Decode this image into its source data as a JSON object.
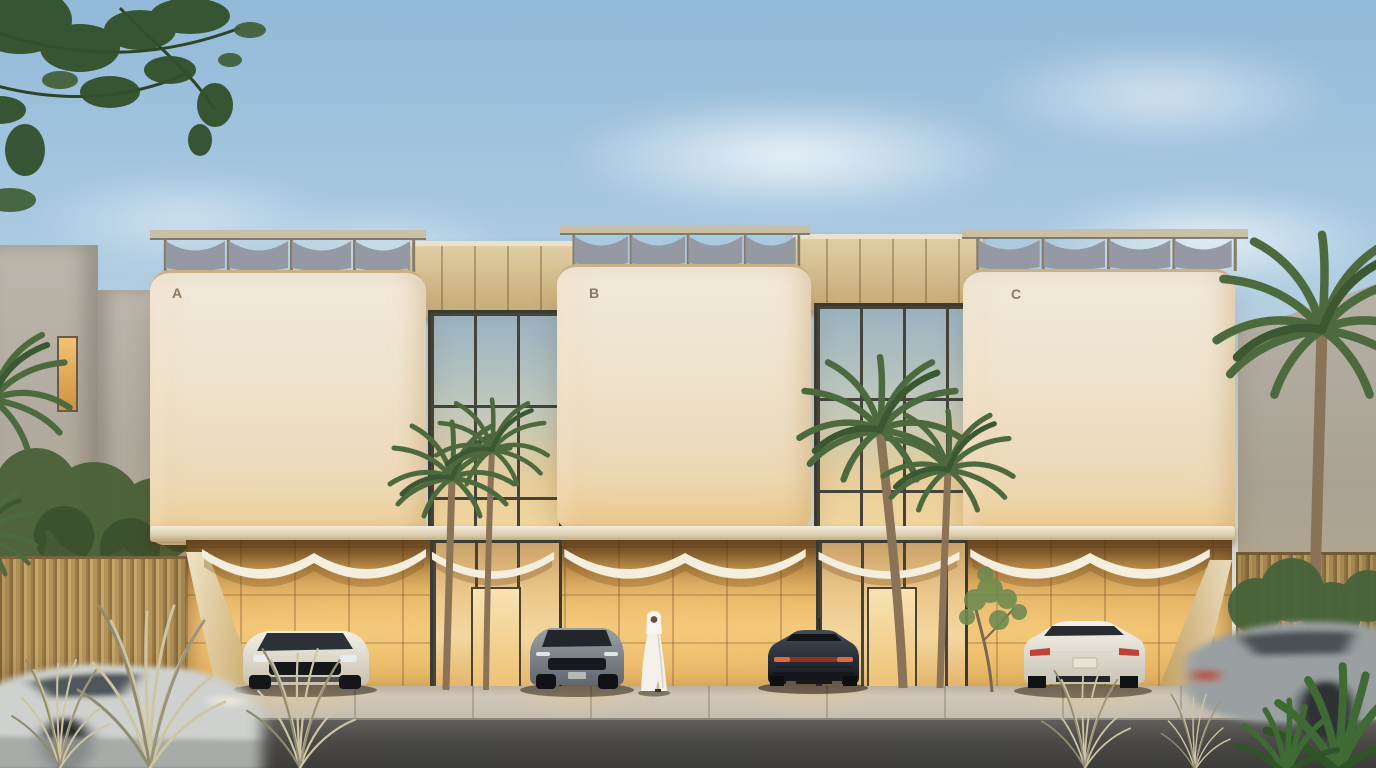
{
  "scene": {
    "description": "Dusk architectural rendering of a three-unit modern villa complex with rooftop pergolas, glowing golden stone ground floor, glass links, palm trees, parked luxury cars and a man in a white kandura",
    "units": [
      {
        "label": "A"
      },
      {
        "label": "B"
      },
      {
        "label": "C"
      }
    ],
    "objects": {
      "vehicles": [
        "white-suv-parked",
        "grey-suv-parked",
        "dark-sedan-parked",
        "white-sedan-parked",
        "motion-blurred-car-left",
        "motion-blurred-car-right"
      ],
      "person": "man-in-white-kandura",
      "vegetation": [
        "palm-trees",
        "street-trees",
        "ornamental-grass",
        "overhanging-branches"
      ]
    },
    "colors": {
      "sky_top": "#93b9d8",
      "sky_horizon": "#e9e2d0",
      "facade_cream": "#eee2cc",
      "stone_gold": "#e2af5f",
      "stone_band": "#d3bf93",
      "glass_mullion": "#45443a",
      "timber_fence": "#c2a167",
      "neighbor_concrete": "#b4aea4",
      "palm_green": "#4e6c41",
      "road_asphalt": "#4a4a48",
      "sidewalk": "#cbc4b8",
      "canopy_fabric": "#f4eede",
      "pergola_sail": "#9599a3"
    }
  }
}
